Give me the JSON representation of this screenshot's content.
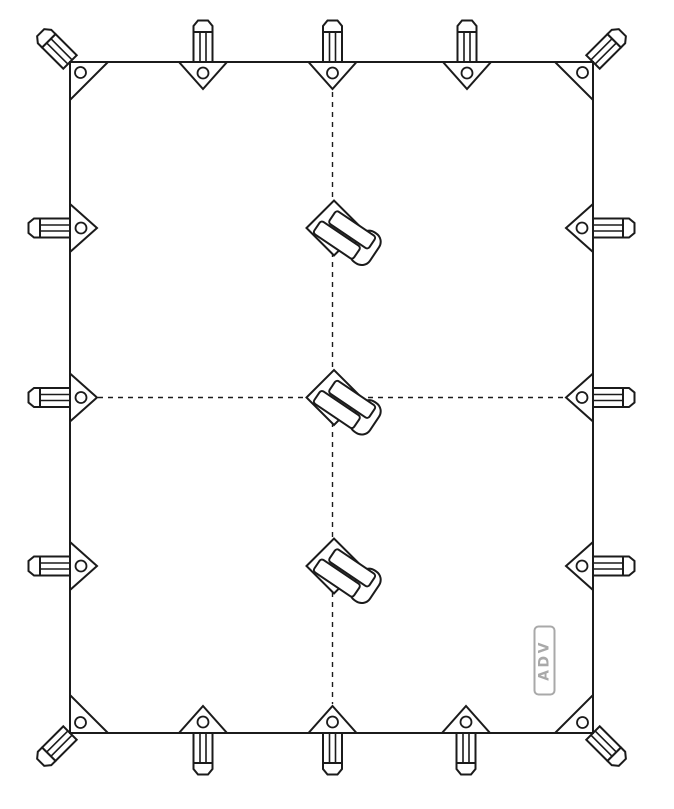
{
  "title": "Tarp attachment points line diagram",
  "colors": {
    "line": "#1b1b1b",
    "background": "#ffffff",
    "shape_fill": "#ffffff",
    "logo": "#a9a9a9"
  },
  "logo": {
    "text": "ADV"
  },
  "diagram": {
    "tarp": {
      "x": 70,
      "y": 62,
      "width": 523,
      "height": 671
    },
    "guides": {
      "vertical": {
        "x": 332.5,
        "y1": 92,
        "y2": 704
      },
      "horizontal": {
        "y": 397.5,
        "x1": 98,
        "x2": 567
      }
    },
    "corner_anchors": [
      {
        "id": "top-left",
        "x": 70,
        "y": 62,
        "dx": 1,
        "dy": 1,
        "peg_angle": -45
      },
      {
        "id": "top-right",
        "x": 593,
        "y": 62,
        "dx": -1,
        "dy": 1,
        "peg_angle": 45
      },
      {
        "id": "bottom-left",
        "x": 70,
        "y": 733,
        "dx": 1,
        "dy": -1,
        "peg_angle": -135
      },
      {
        "id": "bottom-right",
        "x": 593,
        "y": 733,
        "dx": -1,
        "dy": -1,
        "peg_angle": 135
      }
    ],
    "edge_loops": [
      {
        "id": "top-left-quarter",
        "x": 203,
        "y": 62,
        "angle": 0
      },
      {
        "id": "top-center",
        "x": 332.5,
        "y": 62,
        "angle": 0
      },
      {
        "id": "top-right-quarter",
        "x": 467,
        "y": 62,
        "angle": 0
      },
      {
        "id": "right-upper",
        "x": 593,
        "y": 228,
        "angle": 90
      },
      {
        "id": "right-middle",
        "x": 593,
        "y": 397.5,
        "angle": 90
      },
      {
        "id": "right-lower",
        "x": 593,
        "y": 566,
        "angle": 90
      },
      {
        "id": "bottom-left-quarter",
        "x": 203,
        "y": 733,
        "angle": 180
      },
      {
        "id": "bottom-center",
        "x": 332.5,
        "y": 733,
        "angle": 180
      },
      {
        "id": "bottom-right-quarter",
        "x": 466,
        "y": 733,
        "angle": 180
      },
      {
        "id": "left-upper",
        "x": 70,
        "y": 228,
        "angle": 270
      },
      {
        "id": "left-middle",
        "x": 70,
        "y": 397.5,
        "angle": 270
      },
      {
        "id": "left-lower",
        "x": 70,
        "y": 566,
        "angle": 270
      }
    ],
    "center_toggles": [
      {
        "id": "center-upper",
        "x": 334,
        "y": 228,
        "angle": 34
      },
      {
        "id": "center-middle",
        "x": 334,
        "y": 397.5,
        "angle": 34
      },
      {
        "id": "center-lower",
        "x": 334,
        "y": 566,
        "angle": 34
      }
    ],
    "logo_box": {
      "cx": 544.5,
      "cy": 660.5,
      "width": 20,
      "height": 68,
      "rotation": -90
    },
    "counts": {
      "corner_anchors": 4,
      "edge_loops": 12,
      "center_toggles": 3,
      "grommets": 16
    }
  }
}
